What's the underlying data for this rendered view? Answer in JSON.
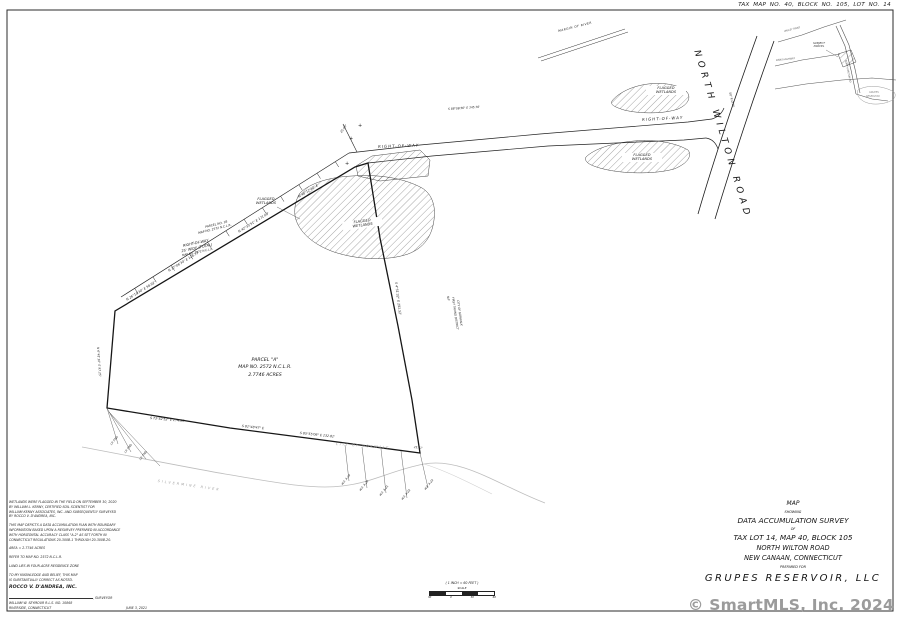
{
  "sheet": {
    "tax_map_line": "TAX MAP NO. 40, BLOCK NO. 105, LOT NO. 14",
    "watermark": "© SmartMLS, Inc. 2024"
  },
  "road": {
    "name": "NORTH WILTON ROAD"
  },
  "parcel": {
    "line1": "PARCEL \"A\"",
    "line2": "MAP NO. 2572 N.C.L.R.",
    "line3": "2.7746 ACRES"
  },
  "labels": {
    "flagged_l1": "FLAGGED",
    "flagged_l2": "WETLANDS",
    "right_of_way": "RIGHT-OF-WAY",
    "row_block_l1": "RIGHT-OF-WAY",
    "row_block_l2": "25' WIDE (TOTAL)",
    "row_block_l3": "MAP NO. 2572 N.C.L.R.",
    "margin_of_river": "MARGIN OF RIVER",
    "city_of_norwalk": "CITY OF NORWALK",
    "river": "SILVERMINE  RIVER",
    "inset_subject_l1": "SUBJECT",
    "inset_subject_l2": "PARCEL"
  },
  "scale_bar": {
    "caption": "( 1 INCH = 60 FEET )",
    "word": "SCALE",
    "ticks": [
      "30",
      "0",
      "30",
      "60"
    ]
  },
  "title_block": {
    "l1": "MAP",
    "l2": "SHOWING",
    "l3": "DATA ACCUMULATION SURVEY",
    "l4": "OF",
    "l5": "TAX LOT 14, MAP 40, BLOCK 105",
    "l6": "NORTH WILTON ROAD",
    "l7": "NEW CANAAN, CONNECTICUT",
    "l8": "PREPARED FOR",
    "l9": "GRUPES RESERVOIR, LLC"
  },
  "notes": {
    "p1": [
      "WETLANDS WERE FLAGGED IN THE FIELD ON SEPTEMBER 30, 2020",
      "BY WILLIAM L. KENNY, CERTIFIED SOIL SCIENTIST FOR",
      "WILLIAM KENNY ASSOCIATES, INC. AND SUBSEQUENTLY SURVEYED",
      "BY ROCCO V. D'ANDREA, INC."
    ],
    "p2": [
      "THIS MAP DEPICTS A DATA ACCUMULATION PLAN WITH BOUNDARY",
      "INFORMATION BASED UPON A RESURVEY PREPARED IN ACCORDANCE",
      "WITH HORIZONTAL ACCURACY CLASS \"A-2\" AS SET FORTH IN",
      "CONNECTICUT REGULATIONS 20-300B-1 THROUGH 20-300B-20."
    ],
    "area": "AREA = 2.7746 ACRES",
    "refer": "REFER TO MAP NO. 2572 N.C.L.R.",
    "zone": "LAND LIES IN FOUR-ACRE RESIDENCE ZONE",
    "belief1": "TO MY KNOWLEDGE AND BELIEF, THIS MAP",
    "belief2": "IS SUBSTANTIALLY CORRECT AS NOTED.",
    "firm": "ROCCO V. D'ANDREA, INC.",
    "surveyor_suffix": ", SURVEYOR",
    "surveyor_name": "WILLIAM W. SEYMOUR   R.L.S. NO. 10868",
    "address": "RIVERSIDE, CONNECTICUT",
    "date": "JUNE 3, 2021"
  },
  "annotations": [
    {
      "name": "bearing-nw-1",
      "text": "N 26°10'30\" E  58.92'",
      "x": 126,
      "y": 299,
      "r": -32,
      "s": 3.2
    },
    {
      "name": "bearing-nw-2",
      "text": "N 37°06'34\" E  128.73'",
      "x": 168,
      "y": 270,
      "r": -32,
      "s": 3.2
    },
    {
      "name": "bearing-nw-3",
      "text": "N 42°33'51\" E  171.68'",
      "x": 238,
      "y": 231,
      "r": -32,
      "s": 3.2
    },
    {
      "name": "bearing-nw-4",
      "text": "N 48°12'40\" E",
      "x": 298,
      "y": 196,
      "r": -32,
      "s": 3.2
    },
    {
      "name": "bearing-s-1",
      "text": "S 73°52'52\" E  174.35'",
      "x": 150,
      "y": 417,
      "r": 5,
      "s": 3.2
    },
    {
      "name": "bearing-s-2",
      "text": "S 81°48'47\" E",
      "x": 242,
      "y": 425,
      "r": 6,
      "s": 3.2
    },
    {
      "name": "bearing-s-3",
      "text": "S 85°55'06\" E  132.81'",
      "x": 300,
      "y": 432,
      "r": 6,
      "s": 3.2
    },
    {
      "name": "bearing-e",
      "text": "S 4°51'32\" E  291.52'",
      "x": 397,
      "y": 282,
      "r": 83,
      "s": 3.2
    },
    {
      "name": "bearing-w",
      "text": "N 6°41'10\" E  97.25'",
      "x": 99,
      "y": 347,
      "r": 86,
      "s": 3
    },
    {
      "name": "bearing-row",
      "text": "S 88°06'56\" E  345.76'",
      "x": 448,
      "y": 108,
      "r": -4,
      "s": 2.9
    },
    {
      "name": "spur-dimension",
      "text": "25.00'",
      "x": 340,
      "y": 132,
      "r": -55,
      "s": 3
    },
    {
      "name": "road-row-width",
      "text": "50' R.O.W.",
      "x": 731,
      "y": 92,
      "r": 76,
      "s": 3
    },
    {
      "name": "monument-1",
      "text": "I.P. FND",
      "x": 110,
      "y": 444,
      "r": -52,
      "s": 2.8
    },
    {
      "name": "monument-2",
      "text": "I.P. FND",
      "x": 124,
      "y": 452,
      "r": -52,
      "s": 2.8
    },
    {
      "name": "monument-3",
      "text": "I.P. FND",
      "x": 139,
      "y": 459,
      "r": -52,
      "s": 2.8
    },
    {
      "name": "dim-25-41",
      "text": "25.41'",
      "x": 414,
      "y": 446,
      "r": 6,
      "s": 2.8
    },
    {
      "name": "wetflag-1",
      "text": "W.F. A-19",
      "x": 341,
      "y": 484,
      "r": -52,
      "s": 2.8
    },
    {
      "name": "wetflag-2",
      "text": "W.F. A-20",
      "x": 359,
      "y": 490,
      "r": -52,
      "s": 2.8
    },
    {
      "name": "wetflag-3",
      "text": "W.F. A-21",
      "x": 379,
      "y": 495,
      "r": -52,
      "s": 2.8
    },
    {
      "name": "wetflag-4",
      "text": "W.F. A-22",
      "x": 401,
      "y": 499,
      "r": -52,
      "s": 2.8
    },
    {
      "name": "wetflag-5",
      "text": "W.F. A-23",
      "x": 424,
      "y": 489,
      "r": -52,
      "s": 2.8
    },
    {
      "name": "parcel-b-line1",
      "text": "PARCEL NO. 1B",
      "x": 205,
      "y": 226,
      "r": -14,
      "s": 3
    },
    {
      "name": "parcel-b-line2",
      "text": "MAP NO. 2572 N.C.L.R.",
      "x": 198,
      "y": 232,
      "r": -14,
      "s": 3
    },
    {
      "name": "abutter-line1",
      "text": "N/F",
      "x": 449,
      "y": 296,
      "r": 82,
      "s": 2.8
    },
    {
      "name": "abutter-line2",
      "text": "FIRST TAXING DISTRICT",
      "x": 454,
      "y": 297,
      "r": 82,
      "s": 2.8
    },
    {
      "name": "abutter-line3",
      "text": "CITY OF NORWALK",
      "x": 459,
      "y": 300,
      "r": 82,
      "s": 2.8
    },
    {
      "name": "corner-cross-1",
      "text": "+",
      "x": 349,
      "y": 137,
      "r": 0,
      "s": 5
    },
    {
      "name": "corner-cross-2",
      "text": "+",
      "x": 358,
      "y": 124,
      "r": 0,
      "s": 5
    },
    {
      "name": "corner-cross-3",
      "text": "+",
      "x": 345,
      "y": 162,
      "r": 0,
      "s": 5
    },
    {
      "name": "inset-road-north-wilton",
      "text": "NORTH WILTON RD",
      "x": 846,
      "y": 60,
      "r": 78,
      "s": 2.4,
      "c": "#555"
    },
    {
      "name": "inset-road-valley",
      "text": "VALLEY ROAD",
      "x": 784,
      "y": 31,
      "r": -14,
      "s": 2.4,
      "c": "#555"
    },
    {
      "name": "inset-road-dans",
      "text": "DANS HIGHWAY",
      "x": 776,
      "y": 60,
      "r": -6,
      "s": 2.4,
      "c": "#555"
    },
    {
      "name": "inset-reservoir-line1",
      "text": "GRUPES",
      "x": 869,
      "y": 92,
      "r": 0,
      "s": 2.4,
      "c": "#888"
    },
    {
      "name": "inset-reservoir-line2",
      "text": "RESERVOIR",
      "x": 866,
      "y": 96,
      "r": 0,
      "s": 2.4,
      "c": "#888"
    }
  ]
}
